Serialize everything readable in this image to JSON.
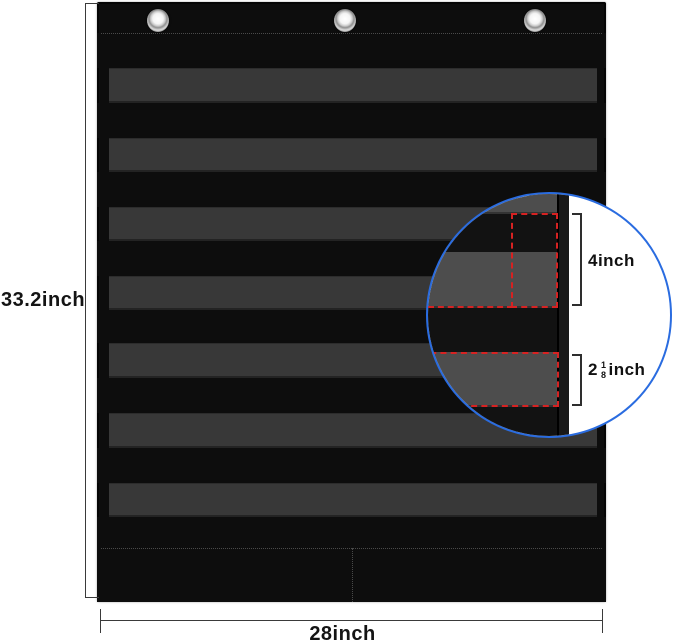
{
  "dimensions": {
    "height_label": "33.2inch",
    "width_label": "28inch"
  },
  "magnifier": {
    "pocket_row_label": "4inch",
    "strip_label": {
      "whole": "2",
      "numerator": "1",
      "denominator": "8",
      "unit": "inch"
    }
  },
  "pocket_chart": {
    "gray_pocket_count": 7,
    "grommet_count": 3
  },
  "colors": {
    "chart_black": "#0d0d0d",
    "pocket_gray": "#383838",
    "magnified_black": "#121212",
    "magnified_gray": "#4d4d4d",
    "magnifier_blue": "#2a6ce0",
    "highlight_red": "#d62222",
    "dimension_line": "#3a3a3a",
    "background": "#ffffff"
  }
}
